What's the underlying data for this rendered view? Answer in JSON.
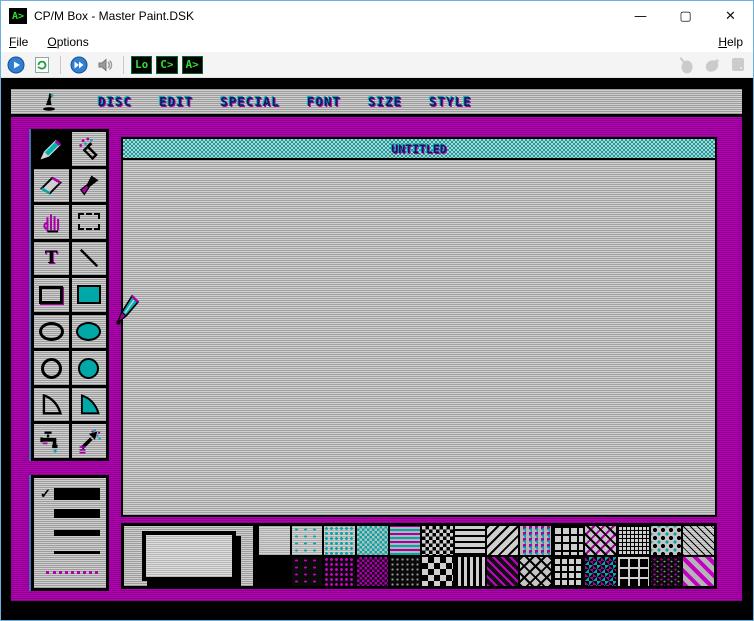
{
  "window": {
    "title": "CP/M Box - Master Paint.DSK",
    "icon_text": "A>",
    "controls": {
      "minimize": "—",
      "maximize": "▢",
      "close": "✕"
    }
  },
  "menubar": {
    "items": [
      "File",
      "Options"
    ],
    "right_item": "Help"
  },
  "toolbar": {
    "buttons": [
      "play",
      "reset",
      "fast-forward",
      "volume"
    ],
    "chips": [
      "Lo",
      "C>",
      "A>"
    ],
    "disabled_buttons": [
      "mouse",
      "mouse-capture",
      "keypad"
    ]
  },
  "screen": {
    "menu": {
      "items": [
        "DISC",
        "EDIT",
        "SPECIAL",
        "FONT",
        "SIZE",
        "STYLE"
      ]
    },
    "canvas": {
      "title": "UNTITLED"
    },
    "tools": {
      "selected": "pencil",
      "text_glyph": "T",
      "items": [
        "pencil",
        "spray",
        "eraser",
        "brush",
        "hand",
        "marquee",
        "text",
        "line",
        "rectangle",
        "rectangle-filled",
        "ellipse",
        "ellipse-filled",
        "circle",
        "circle-filled",
        "slope",
        "slope-filled",
        "faucet",
        "fill-spray"
      ]
    },
    "line_widths": {
      "check_glyph": "✓",
      "selected_index": 0,
      "options": [
        "extra-thick",
        "thick",
        "medium",
        "thin",
        "dotted"
      ]
    },
    "patterns": {
      "row1": [
        "blank",
        "cyan-dots-sparse",
        "cyan-dots",
        "cyan-dither",
        "cyan-magenta-lines",
        "checker-fine",
        "h-stripes",
        "diag-stripes",
        "noise-color",
        "grid",
        "zigzag",
        "basketweave",
        "star-dots",
        "diag-hatch"
      ],
      "row2": [
        "black",
        "magenta-dots-sparse",
        "magenta-dots",
        "magenta-dither",
        "dark-speckle",
        "checker-large",
        "v-stripes",
        "magenta-diag-dither",
        "cross-hatch",
        "bricks",
        "cyan-magenta-check",
        "dark-noise",
        "window-grid",
        "magenta-diag-stripes"
      ]
    }
  },
  "colors": {
    "magenta": "#A800A8",
    "cyan": "#00A8A8",
    "screen_gray": "#C0C0C0",
    "chip_green": "#2EE02E",
    "window_border": "#6CB2E0",
    "selection_bg": "#000000"
  }
}
